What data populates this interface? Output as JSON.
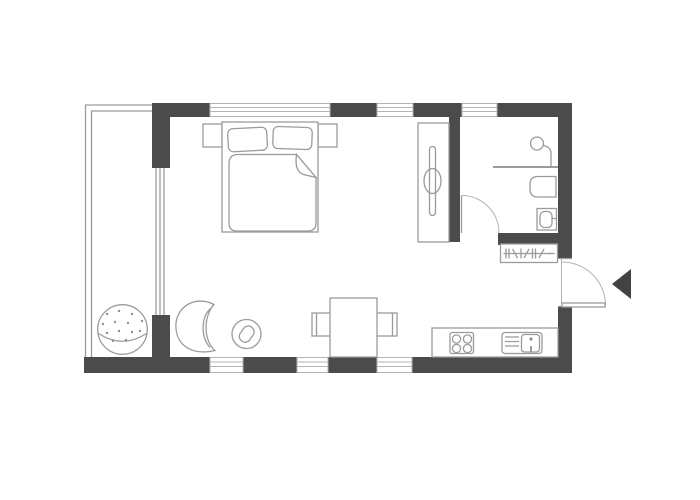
{
  "page": {
    "background": "#ffffff"
  },
  "colors": {
    "wall": "#4b4b4b",
    "line": "#9b9b9b",
    "line_light": "#b3b3b3",
    "white": "#ffffff",
    "arrow": "#424242",
    "dot": "#8f8f8f"
  },
  "plan": {
    "label": "Studio apartment floor plan",
    "rooms": [
      {
        "name": "balcony"
      },
      {
        "name": "main-room"
      },
      {
        "name": "bathroom"
      }
    ],
    "furniture": [
      "double-bed",
      "pillow-left",
      "pillow-right",
      "duvet-with-folded-corner",
      "nightstand-left",
      "nightstand-right",
      "wardrobe",
      "shower-screen",
      "shower-head",
      "toilet",
      "washbasin",
      "radiator",
      "dining-table",
      "dining-chair-left",
      "dining-chair-right",
      "kitchen-counter",
      "cooktop-4-burners",
      "kitchen-sink",
      "egg-chair",
      "round-side-table",
      "ball-chair"
    ],
    "doors": [
      "entrance-door-right-wall",
      "bathroom-door"
    ],
    "windows": [
      "top-window-large",
      "top-window-middle",
      "top-window-right",
      "bottom-window-left",
      "bottom-window-center",
      "bottom-window-right",
      "balcony-glazing"
    ],
    "entrance_arrow_direction": "left"
  }
}
